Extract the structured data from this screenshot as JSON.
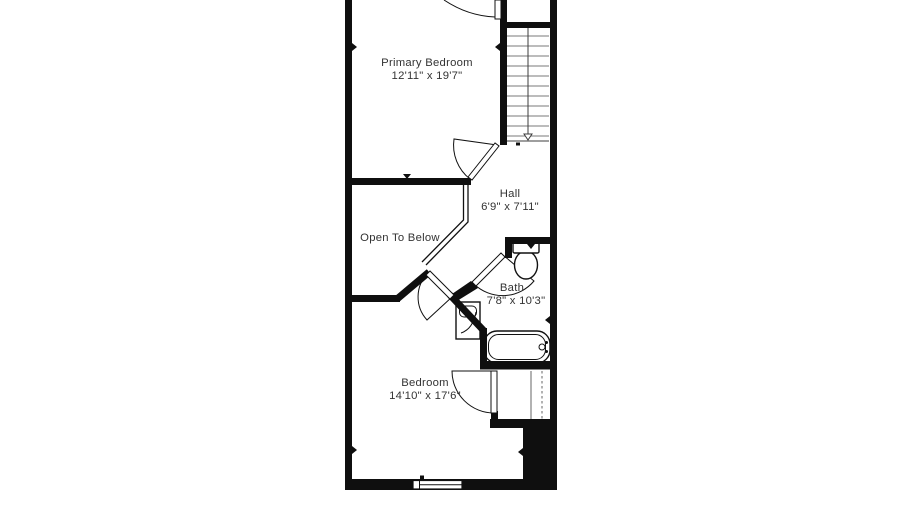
{
  "floor_plan": {
    "colors": {
      "background": "#ffffff",
      "walls": "#0f0f0f",
      "text": "#333333"
    },
    "rooms": {
      "primary_bedroom": {
        "name": "Primary Bedroom",
        "dimensions": "12'11\" x 19'7\""
      },
      "hall": {
        "name": "Hall",
        "dimensions": "6'9\" x 7'11\""
      },
      "open_to_below": {
        "name": "Open To Below"
      },
      "bath": {
        "name": "Bath",
        "dimensions": "7'8\" x 10'3\""
      },
      "bedroom": {
        "name": "Bedroom",
        "dimensions": "14'10\" x 17'6\""
      }
    },
    "fixtures": {
      "staircase": "staircase with down arrow",
      "toilet": "toilet",
      "bathtub": "bathtub",
      "vanity": "sink vanity",
      "closet": "closet with hanging rod",
      "window": "window",
      "doors": "four swing doors"
    }
  }
}
